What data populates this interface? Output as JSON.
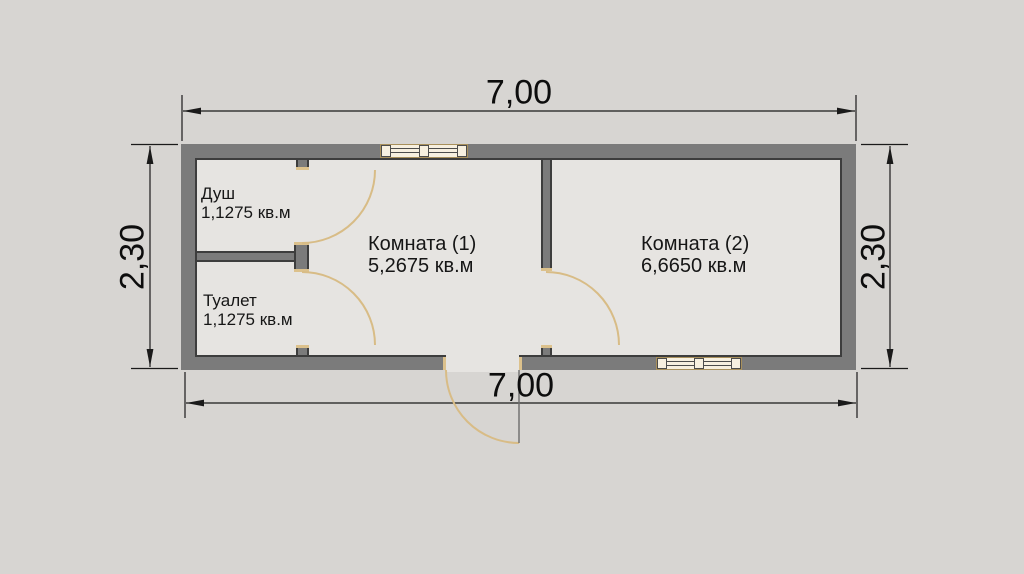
{
  "dimensions": {
    "top_width": "7,00",
    "bottom_width": "7,00",
    "left_height": "2,30",
    "right_height": "2,30"
  },
  "rooms": [
    {
      "name": "Душ",
      "area": "1,1275 кв.м"
    },
    {
      "name": "Туалет",
      "area": "1,1275 кв.м"
    },
    {
      "name": "Комната (1)",
      "area": "5,2675 кв.м"
    },
    {
      "name": "Комната (2)",
      "area": "6,6650 кв.м"
    }
  ],
  "colors": {
    "background": "#d7d5d2",
    "room_interior": "#e6e4e1",
    "wall_fill": "#7b7b7b",
    "wall_outline": "#3d3d3d",
    "door_arc": "#d8bc86",
    "window_fill": "#f7f0e0",
    "window_frame": "#a8905c",
    "dimension_line": "#1a1a1a",
    "text": "#111111"
  }
}
